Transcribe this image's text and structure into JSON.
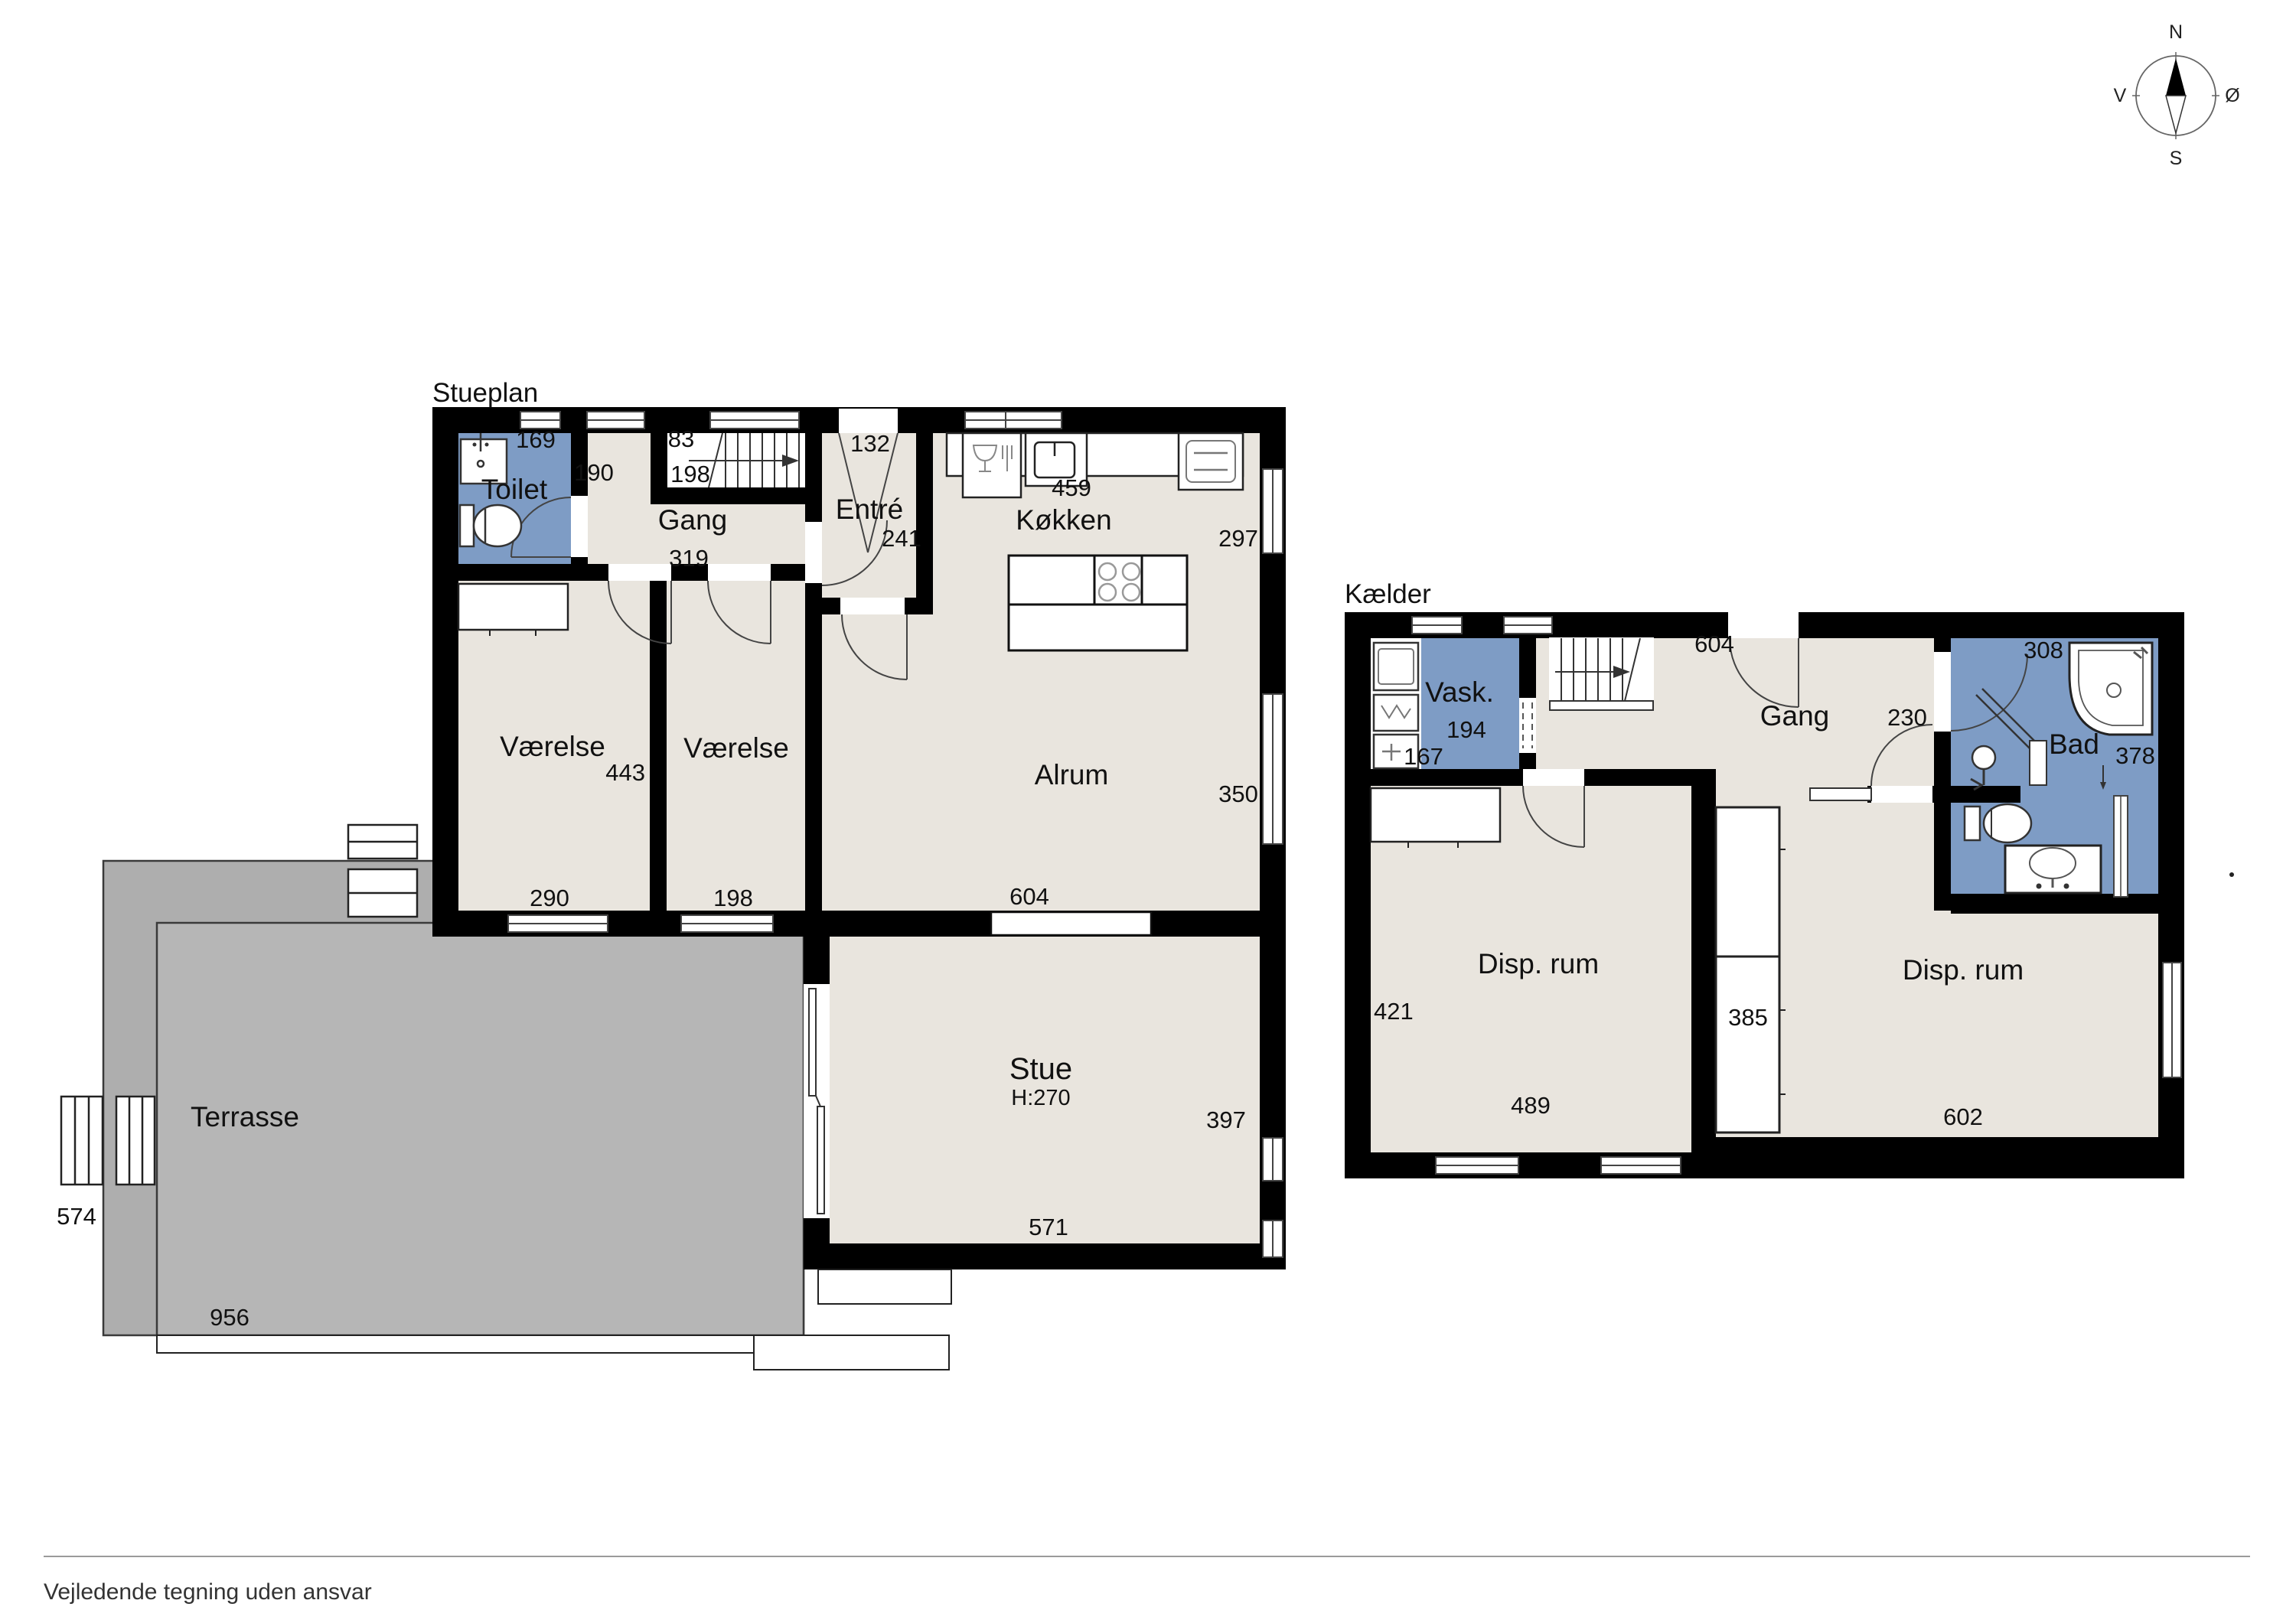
{
  "document": {
    "type": "floor-plan-drawing",
    "disclaimer": "Vejledende tegning uden ansvar"
  },
  "compass": {
    "n": "N",
    "s": "S",
    "v": "V",
    "o": "Ø"
  },
  "ground": {
    "title": "Stueplan",
    "toilet": "Toilet",
    "gang": "Gang",
    "entre": "Entré",
    "kokken": "Køkken",
    "alrum": "Alrum",
    "vaerelse1": "Værelse",
    "vaerelse2": "Værelse",
    "stue": "Stue",
    "stue_height": "H:270",
    "terrasse": "Terrasse",
    "d169": "169",
    "d190": "190",
    "d83": "83",
    "d198_stair": "198",
    "d132": "132",
    "d241": "241",
    "d459": "459",
    "d297": "297",
    "d319": "319",
    "d443": "443",
    "d290": "290",
    "d198": "198",
    "d604": "604",
    "d350": "350",
    "d397": "397",
    "d571": "571",
    "d574": "574",
    "d956": "956"
  },
  "basement": {
    "title": "Kælder",
    "vask": "Vask.",
    "gang": "Gang",
    "bad": "Bad",
    "disp1": "Disp. rum",
    "disp2": "Disp. rum",
    "d194": "194",
    "d167": "167",
    "d604": "604",
    "d230": "230",
    "d308": "308",
    "d378": "378",
    "d421": "421",
    "d489": "489",
    "d385": "385",
    "d602": "602"
  },
  "colors": {
    "floor": "#e9e5de",
    "wet_room": "#7e9cc5",
    "terrace_outer": "#aeaeae",
    "terrace_inner": "#b6b6b6",
    "wall": "#000000"
  }
}
